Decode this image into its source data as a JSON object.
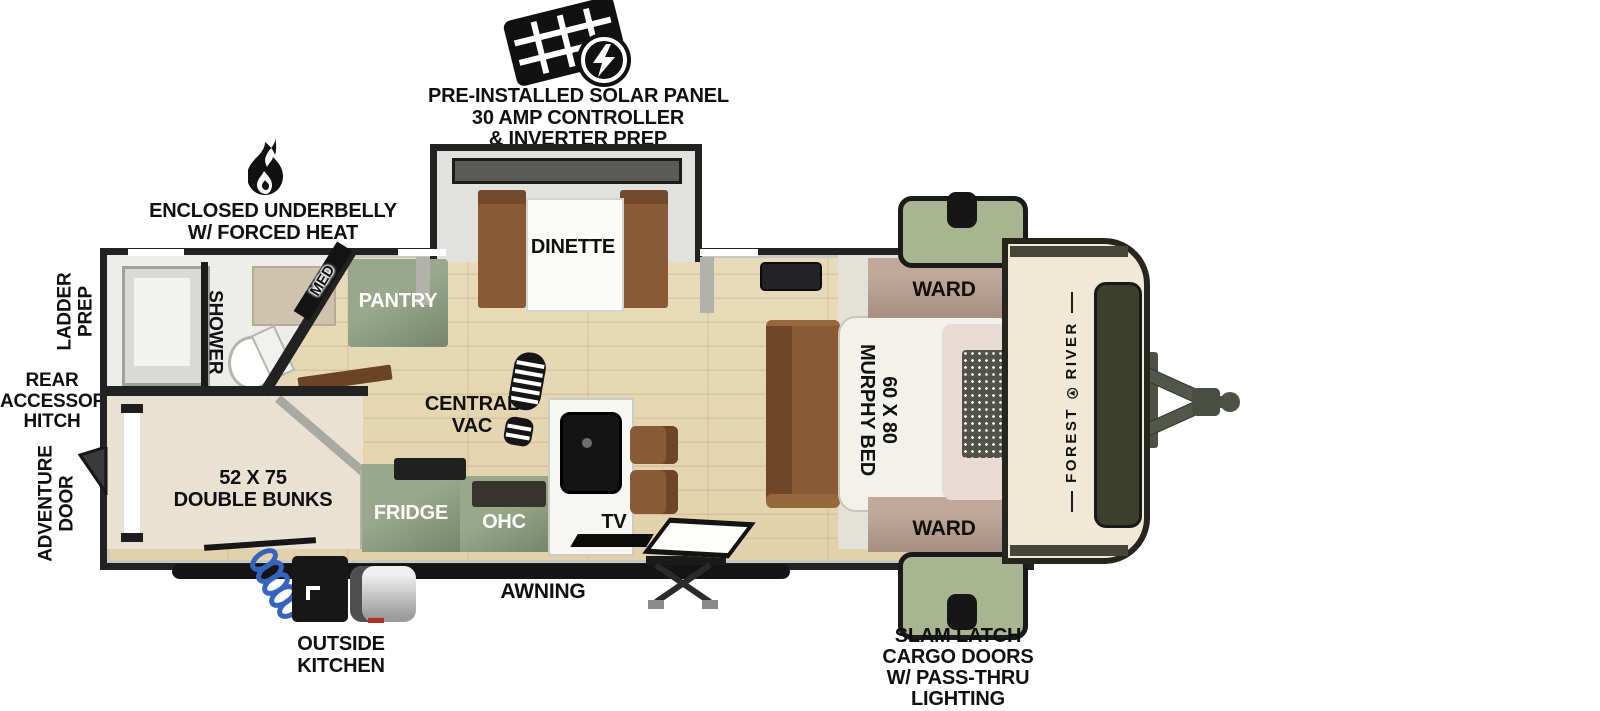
{
  "solar_note": [
    "PRE-INSTALLED SOLAR PANEL",
    "30 AMP CONTROLLER",
    "& INVERTER PREP"
  ],
  "underbelly_note": [
    "ENCLOSED UNDERBELLY",
    "W/ FORCED HEAT"
  ],
  "side_labels": {
    "ladder_prep": [
      "LADDER",
      "PREP"
    ],
    "rear_hitch": [
      "REAR",
      "ACCESSORY",
      "HITCH"
    ],
    "adventure_door": [
      "ADVENTURE",
      "DOOR"
    ]
  },
  "rooms": {
    "dinette": "DINETTE",
    "pantry": "PANTRY",
    "med": "MED",
    "shower": "SHOWER",
    "central_vac": [
      "CENTRAL",
      "VAC"
    ],
    "double_bunks": [
      "52 X 75",
      "DOUBLE BUNKS"
    ],
    "fridge": "FRIDGE",
    "ohc": "OHC",
    "tv": "TV",
    "ward_top": "WARD",
    "ward_bottom": "WARD",
    "murphy_bed": [
      "60 X 80",
      "MURPHY BED"
    ]
  },
  "exterior": {
    "awning": "AWNING",
    "outside_kitchen": [
      "OUTSIDE",
      "KITCHEN"
    ],
    "cargo_doors": [
      "SLAM LATCH",
      "CARGO DOORS",
      "W/ PASS-THRU",
      "LIGHTING"
    ],
    "brand": [
      "FOREST",
      "RIVER"
    ]
  },
  "icons": {
    "solar": "solar-panel-icon with lightning-bolt",
    "heat": "flame-icon",
    "central_vac": "boot-print-icon",
    "hose": "coiled-hose-icon",
    "hitch": "a-frame-hitch-icon"
  },
  "colors": {
    "outline": "#222222",
    "cabinet_green": "#8b9a7c",
    "cargo_door_green": "#a9b590",
    "ward_tan": "#b49a8c",
    "furniture_brown": "#8a5a36",
    "wood_floor": "#e6d8b6",
    "bunk_floor": "#e9e2d3",
    "cap_cream": "#f0e9d5",
    "front_window_olive": "#3d3f2d",
    "hose_blue": "#3563be"
  }
}
